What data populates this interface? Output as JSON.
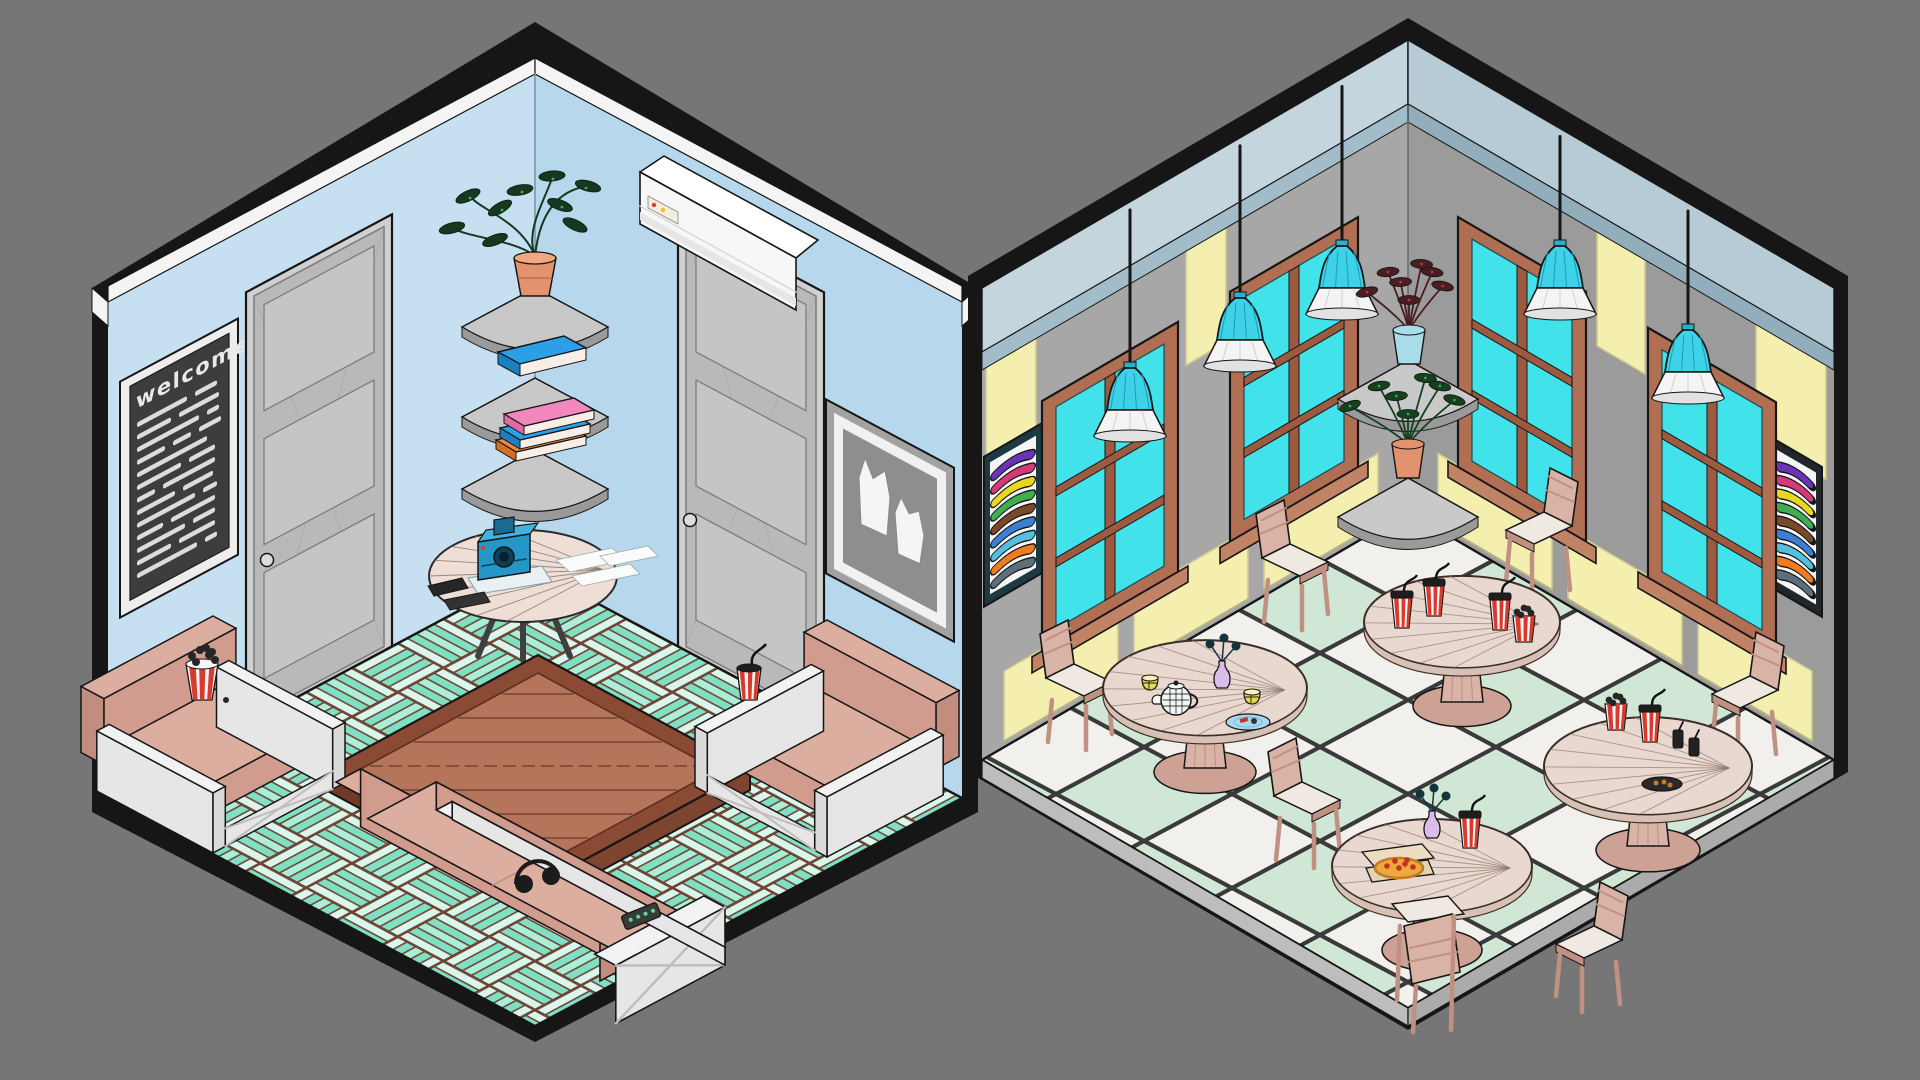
{
  "scene": {
    "title": "Two low-poly isometric rooms: living room and cafe",
    "background": "#767676",
    "outline": "#161616"
  },
  "left_room": {
    "name": "living-room",
    "walls": {
      "left": "#c6e0f2",
      "right": "#b7d8ec",
      "cornice": "#f4f4f4",
      "corner_line": "#7d98a8"
    },
    "floor": {
      "plank_light": "#d9f7ed",
      "plank_teal": "#7fe0c3",
      "plank_mid": "#abeeda",
      "seam": "#6e4434"
    },
    "welcome_board": {
      "text": "welcome",
      "lines": 13,
      "board": "#3d3d3d",
      "frame": "#ededed",
      "text_color": "#e9e9e9"
    },
    "door": {
      "frame": "#d0d0d0",
      "leaf": "#b9b9b9",
      "panel": "#c5c5c5",
      "edge": "#7e7e7e",
      "knob": "#dcdcdc",
      "count": 2
    },
    "picture": {
      "frame": "#a2a2a2",
      "mat": "#f1f1f1",
      "canvas": "#8e8e8e",
      "figures": "#f5f5f5"
    },
    "ac_unit": {
      "body": "#f7f7f7",
      "top": "#ffffff",
      "vent": "#e6e6e6",
      "panel": "#f4eedd",
      "light_red": "#e03c2e",
      "light_yellow": "#f0c028"
    },
    "shelf": {
      "top": "#c8c8c8",
      "rim": "#9a9a9a",
      "count": 3
    },
    "plant": {
      "pot": "#e2926c",
      "pot_rim": "#f0a87e",
      "leaf": "#16381f",
      "speckle": "#41b060"
    },
    "books": {
      "blue": "#2ba0e8",
      "blue_side": "#1b7fc0",
      "pink": "#f287be",
      "pink_side": "#e06aa6",
      "orange": "#f0883a",
      "orange_side": "#d06f28",
      "pages": "#f7efe7"
    },
    "side_table": {
      "top": "#eeded5",
      "leg": "#3f3f3f"
    },
    "camera": {
      "body": "#2596c8",
      "top": "#40b4dc",
      "lens": "#0f3e56",
      "lens_core": "#071f2c",
      "finder": "#1b6a92",
      "dot": "#e03c2e",
      "tray": "#e9f0f2",
      "paper": "#fbfbfb",
      "notebook": "#262626"
    },
    "seating": {
      "cushion": "#dcae9f",
      "cushion_front": "#d19c8d",
      "cushion_side": "#c28d7e",
      "frame": "#f2f2f2",
      "frame_side": "#e6e6e6",
      "frame_front": "#dadada"
    },
    "coffee_table": {
      "top": "#b5755b",
      "frame": "#8a4a33",
      "side": "#6f3a26",
      "side2": "#7d4430",
      "line": "#5a3020"
    },
    "popcorn": {
      "red": "#d93a2e",
      "white": "#f5f5f5",
      "kernel": "#262626"
    },
    "cup": {
      "red": "#d93a2e",
      "white": "#f5f5f5",
      "lid": "#1e1e1e",
      "straw": "#111111"
    },
    "headphones": "#1b1b1b",
    "remote": {
      "body": "#3a3a3a",
      "button": "#57d8a0"
    }
  },
  "right_room": {
    "name": "cafe",
    "walls": {
      "left": "#a7a7a7",
      "right": "#9b9b9b",
      "corner_line": "#6a6a6a"
    },
    "ceiling": {
      "left": "#c5d5de",
      "right": "#b7cbd6",
      "fascia_left": "#a2bcc9",
      "fascia_right": "#92aebc"
    },
    "panel": {
      "fill": "#f4efae",
      "edge": "#cfc993",
      "shadow": "#b8b285"
    },
    "window": {
      "frame": "#b06e53",
      "mullion": "#9c5a40",
      "sill": "#c08366",
      "glass": "#41e2ea",
      "count": 4
    },
    "poster": {
      "face": "#f6f6f6",
      "frame_left": "#1d3a42",
      "frame_right": "#20262a",
      "stripes": [
        "#6a35b5",
        "#d23a78",
        "#e8d821",
        "#3fae4f",
        "#7a4a28",
        "#3a7fd2",
        "#54bede",
        "#ef7d1f",
        "#5d6f7b"
      ]
    },
    "lamp": {
      "cord": "#151515",
      "shade": "#3ed2e8",
      "shade_line": "#1d9cb4",
      "neck": "#2ab0c8",
      "skirt": "#f4f4f4",
      "skirt_inner": "#e2e2e2",
      "count": 5
    },
    "shelf": {
      "top": "#c9c9c9",
      "rim": "#9a9a9a",
      "count": 2
    },
    "plant_top": {
      "pot": "#a8dce8",
      "leaf": "#4a1d22",
      "speckle": "#c03a3a"
    },
    "plant_bottom": {
      "pot": "#e2926c",
      "leaf": "#17401f",
      "speckle": "#3fae5f"
    },
    "table": {
      "top": "#e9d8cf",
      "rim": "#d8c0b4",
      "pedestal": "#d9b3a6",
      "base": "#cda294",
      "line": "#8a756b",
      "count": 4
    },
    "chair": {
      "wood": "#d9b3a6",
      "wood_dark": "#c09182",
      "pad": "#efe9e2",
      "count": 7
    },
    "floor": {
      "tile_light": "#f1f0ed",
      "tile_mint": "#cfe7d4",
      "grout": "#3a3a3a",
      "slab_left": "#bdbdbd",
      "slab_right": "#ababab"
    },
    "items": {
      "milkshake": {
        "red": "#d93a2e",
        "white": "#f5f5f5",
        "lid": "#1e1e1e"
      },
      "teapot": {
        "body": "#f2f6f4",
        "line": "#1d1d1d"
      },
      "teacup": {
        "body": "#e8d84a",
        "rim": "#f7f0c0",
        "line": "#1d1d1d"
      },
      "vase": {
        "body": "#d9bce8",
        "flower": "#14333d"
      },
      "plate": {
        "blue": "#a8d8ef",
        "blue_rim": "#7ab8d8",
        "dark": "#2a2a2a",
        "food": "#c23322"
      },
      "pizza": {
        "box": "#ecdcc2",
        "box_base": "#e4d2b4",
        "pie": "#eda93e",
        "crust": "#c07c28",
        "pepperoni": "#c23322"
      },
      "popcorn": {
        "red": "#d93a2e",
        "white": "#f5f5f5",
        "kernel": "#262626"
      },
      "bottle": "#222222"
    }
  }
}
